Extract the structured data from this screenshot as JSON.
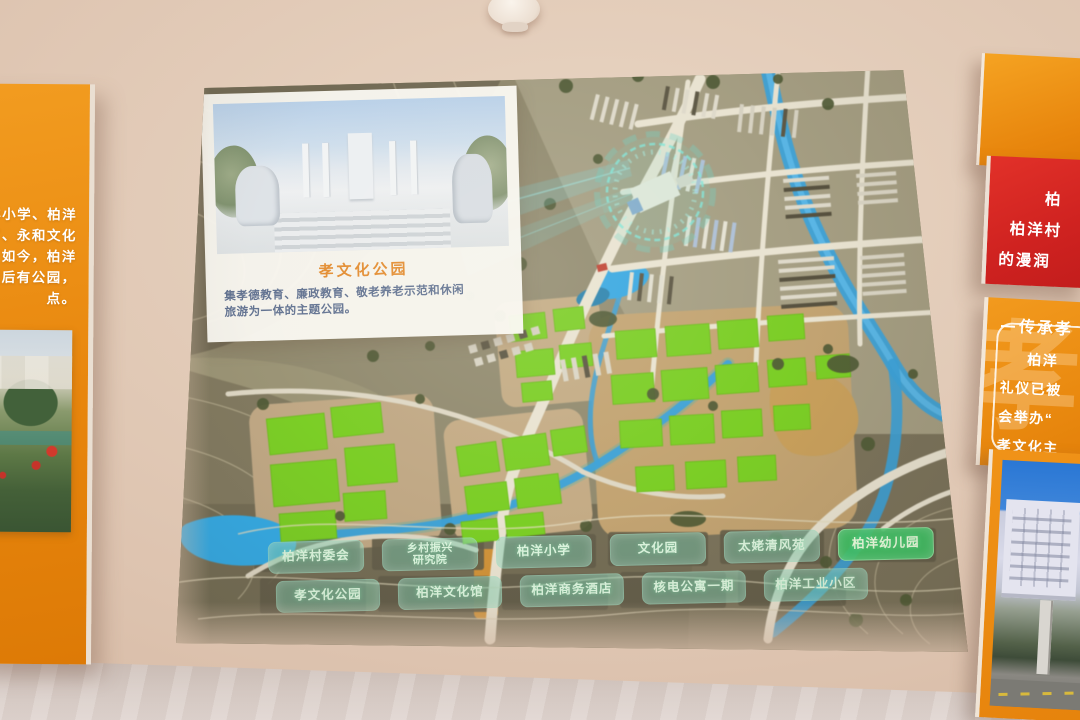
{
  "scene": {
    "left_panel": {
      "lines": [
        "洋小学、柏洋",
        "厂、永和文化",
        "。如今，柏洋",
        "屋后有公园，",
        "点。"
      ]
    },
    "right_red_panel": {
      "lines": [
        "柏",
        "柏洋村",
        "的漫润"
      ]
    },
    "right_orange_panel": {
      "title": "传承孝",
      "watermark": "孝",
      "lines": [
        "柏洋",
        "礼仪已被",
        "会举办“",
        "孝文化主"
      ]
    }
  },
  "map": {
    "inset_card": {
      "title": "孝文化公园",
      "desc_line1": "集孝德教育、廉政教育、敬老养老示范和休闲",
      "desc_line2": "旅游为一体的主题公园。"
    },
    "labels_row1": [
      {
        "text": "柏洋村委会"
      },
      {
        "line1": "乡村振兴",
        "line2": "研究院"
      },
      {
        "text": "柏洋小学"
      },
      {
        "text": "文化园"
      },
      {
        "text": "太姥清风苑"
      },
      {
        "text": "柏洋幼儿园"
      }
    ],
    "labels_row2": [
      {
        "text": "孝文化公园"
      },
      {
        "text": "柏洋文化馆"
      },
      {
        "text": "柏洋商务酒店"
      },
      {
        "text": "核电公寓一期"
      },
      {
        "text": "柏洋工业小区"
      }
    ],
    "colors": {
      "field_green": "#73ce16",
      "river_blue": "#2f9fdc",
      "label_teal": "rgba(125,205,175,0.5)",
      "highlight_green": "#3ac463",
      "panel_orange": "#e8860d",
      "panel_red": "#cf2220"
    }
  }
}
